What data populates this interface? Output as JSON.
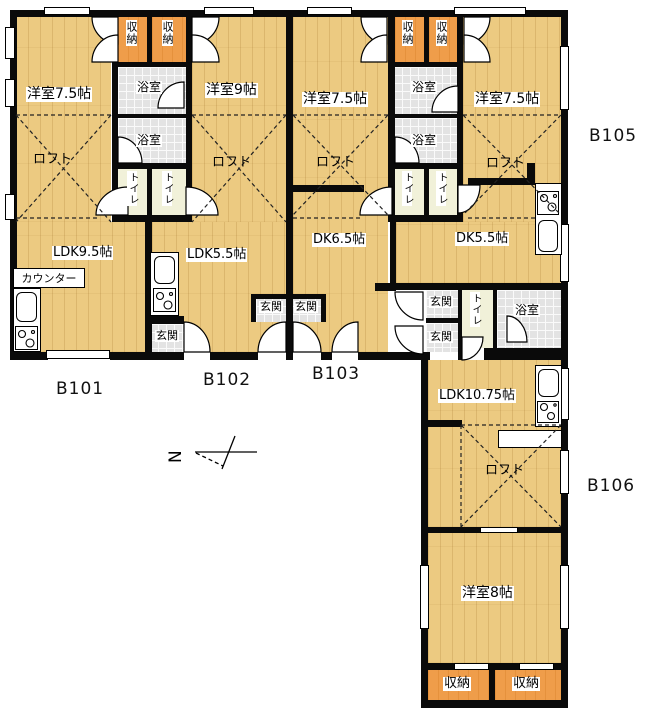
{
  "labels": {
    "room75": "洋室7.5帖",
    "room9": "洋室9帖",
    "room8": "洋室8帖",
    "loft": "ロフト",
    "ldk95": "LDK9.5帖",
    "ldk55": "LDK5.5帖",
    "dk65": "DK6.5帖",
    "dk55": "DK5.5帖",
    "ldk1075": "LDK10.75帖",
    "counter": "カウンター",
    "closet": "収納",
    "bath": "浴室",
    "toilet": "トイレ",
    "entry": "玄関"
  },
  "units": {
    "b101": "B101",
    "b102": "B102",
    "b103": "B103",
    "b105": "B105",
    "b106": "B106"
  },
  "compass": {
    "north": "N"
  }
}
